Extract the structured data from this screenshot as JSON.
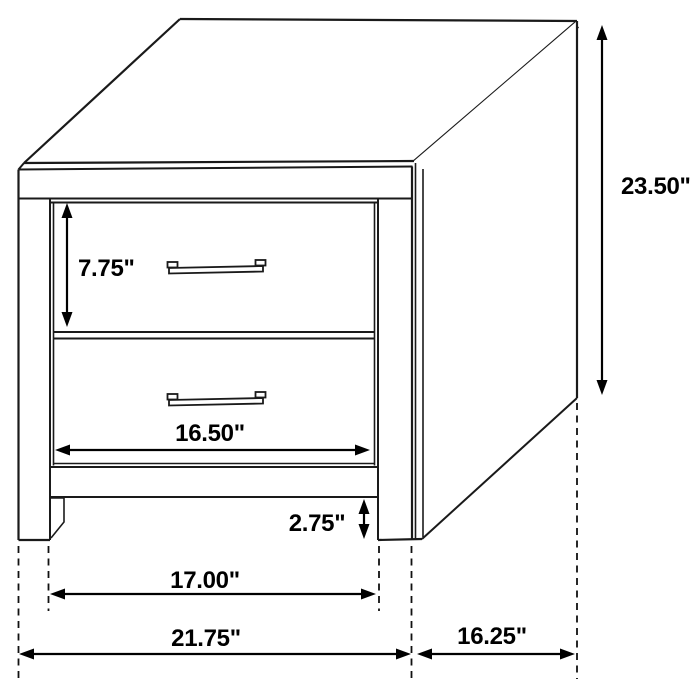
{
  "diagram": {
    "subject": "two-drawer nightstand line drawing",
    "units": "inches",
    "colors": {
      "background": "#ffffff",
      "drawing_line": "#1a1a1a",
      "dimension_line": "#000000",
      "dimension_text": "#000000"
    }
  },
  "dimensions": {
    "overall_height": "23.50\"",
    "top_drawer_height": "7.75\"",
    "drawer_width": "16.50\"",
    "foot_height": "2.75\"",
    "between_legs_width": "17.00\"",
    "overall_width": "21.75\"",
    "overall_depth": "16.25\""
  }
}
